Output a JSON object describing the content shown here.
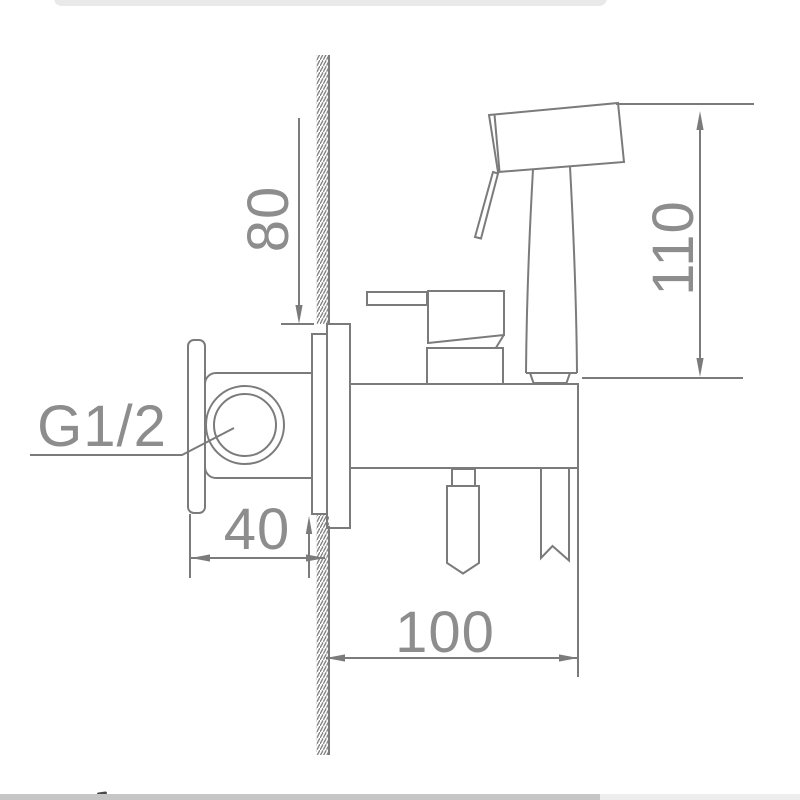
{
  "drawing": {
    "title_semantic": "bidet-sprayer-mixer-installation-diagram",
    "thread_label": "G1/2",
    "dim_wall_offset": "80",
    "dim_sprayer_height": "110",
    "dim_wall_clearance": "40",
    "dim_body_length": "100"
  },
  "colors": {
    "background": "#ffffff",
    "line": "#7b7b7b",
    "text": "#8d8d8d",
    "top_bar": "#e9e9ea",
    "scrollbar_track": "#ededed",
    "scrollbar_thumb": "#c6c6c6"
  }
}
